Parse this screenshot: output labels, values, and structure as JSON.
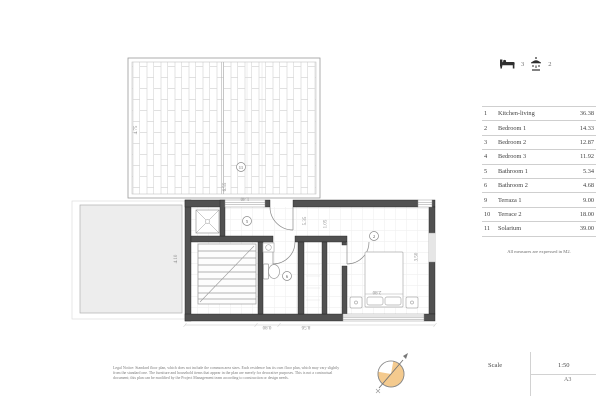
{
  "summary": {
    "bedrooms_count": "3",
    "bathrooms_count": "2",
    "bed_icon": "bed-icon",
    "shower_icon": "shower-icon"
  },
  "area_table": {
    "rows": [
      {
        "num": "1",
        "name": "Kitchen-living",
        "area": "36.38"
      },
      {
        "num": "2",
        "name": "Bedroom 1",
        "area": "14.33"
      },
      {
        "num": "3",
        "name": "Bedroom 2",
        "area": "12.87"
      },
      {
        "num": "4",
        "name": "Bedroom 3",
        "area": "11.92"
      },
      {
        "num": "5",
        "name": "Bathroom 1",
        "area": "5.34"
      },
      {
        "num": "6",
        "name": "Bathroom 2",
        "area": "4.68"
      },
      {
        "num": "9",
        "name": "Terraza 1",
        "area": "9.00"
      },
      {
        "num": "10",
        "name": "Terrace 2",
        "area": "18.00"
      },
      {
        "num": "11",
        "name": "Solarium",
        "area": "39.00"
      }
    ],
    "note": "All measures are expressed in M2."
  },
  "title_block": {
    "scale_label": "Scale",
    "scale_value": "1:50",
    "sheet_size": "A3"
  },
  "disclaimer": {
    "line1": "Legal Notice: Standard floor plan, which does not include the common area sizes. Each residence has its own floor plan, which may vary slightly",
    "line2": "from the standard one. The furniture and household items that appear in the plan are merely for decorative purposes. This is not a contractual",
    "line3": "document; this plan can be modified by the Project Management team according to construction or design needs."
  },
  "plan": {
    "dimensions": {
      "solarium_height": "4.75",
      "solarium_width": "6.55",
      "top_window": "1.40",
      "terrace_side": "4.10",
      "hall_depth": "5.35",
      "closet_width": "1.05",
      "bedroom_depth": "3.50",
      "bed_width": "2.80",
      "door_width": "0.80",
      "total_width": "8.56"
    },
    "room_markers": {
      "solarium": "11",
      "bathroom1": "5",
      "bathroom2": "6",
      "bedroom1": "2"
    },
    "colors": {
      "wall": "#515151",
      "tile_line": "#d8d8d8",
      "terrace_fill": "#ededed",
      "compass_fill": "#f4ca8e",
      "dim_text": "#8a8a8a"
    }
  }
}
